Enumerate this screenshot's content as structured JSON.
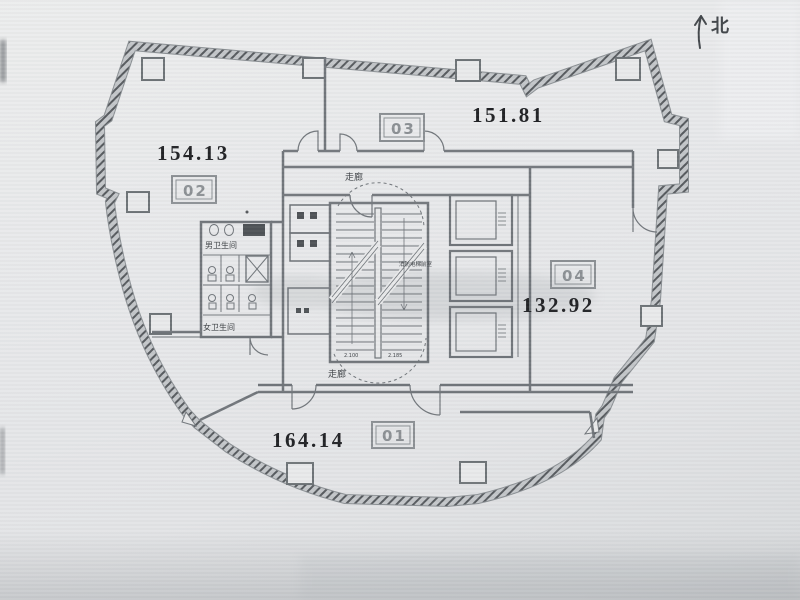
{
  "page": {
    "type": "scanned architectural floor plan, office tower plate"
  },
  "north": {
    "label": "北"
  },
  "units": [
    {
      "id": "01",
      "area": "164.14",
      "position": "bottom"
    },
    {
      "id": "02",
      "area": "154.13",
      "position": "top-left"
    },
    {
      "id": "03",
      "area": "151.81",
      "position": "top-right"
    },
    {
      "id": "04",
      "area": "132.92",
      "position": "right"
    }
  ],
  "labels": {
    "corridor_top": "走廊",
    "corridor_bottom": "走廊",
    "mens_restroom": "男卫生间",
    "womens_restroom": "女卫生间",
    "fire_elevator_lobby": "消防电梯前室",
    "stair_note_left": "2.100",
    "stair_note_right": "2.185"
  },
  "colors": {
    "paper": "#e7e8ea",
    "wall_hatch": "#565a5e",
    "line": "#70757a",
    "ink": "#1f2023",
    "label_gray": "#8b9094"
  }
}
